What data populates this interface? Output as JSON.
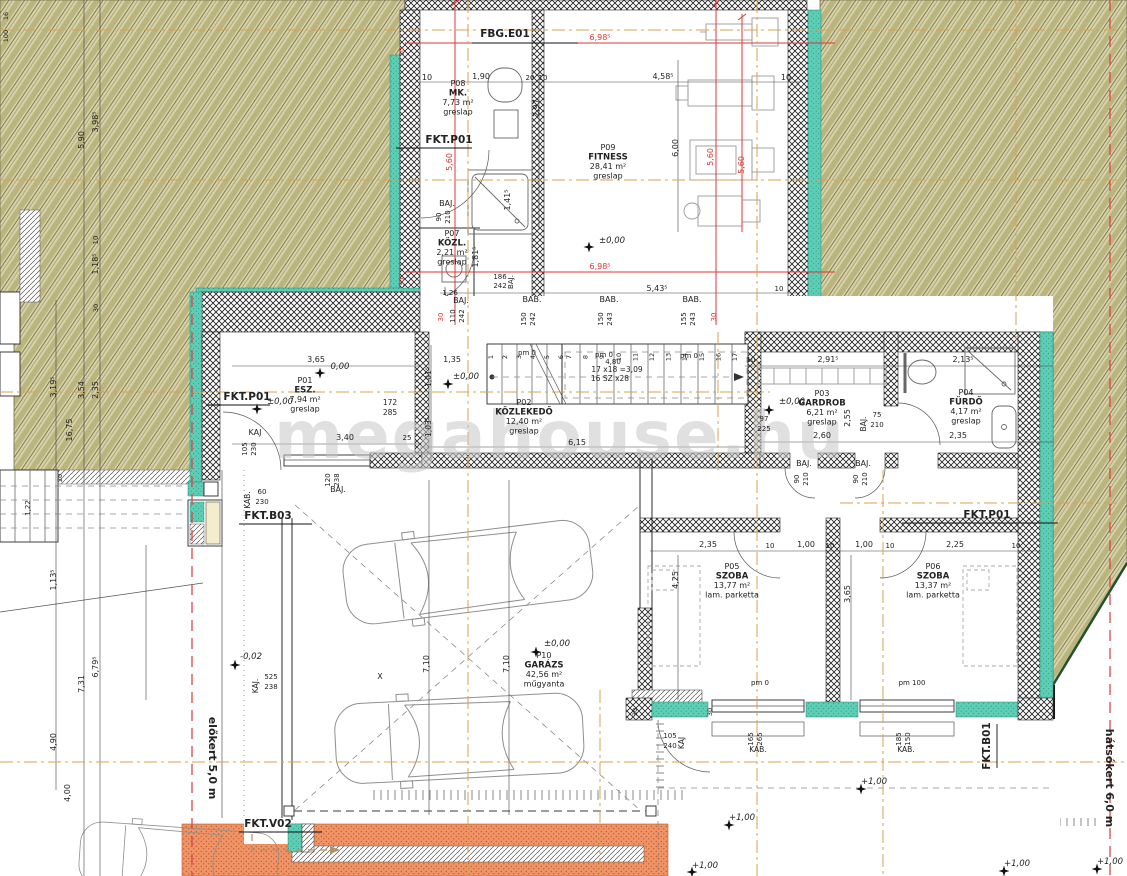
{
  "watermark": "megahouse.hu",
  "site": {
    "front": "előkert 5,0 m",
    "rear": "hátsókert 6,0 m"
  },
  "colors": {
    "terrain": "#d7d2a8",
    "terrain_stripe": "#bab47f",
    "teal": "#5ecdb5",
    "orange": "#f09467",
    "red_dim": "#e03434",
    "axis_orange": "#d7a254",
    "watermark_gray": "#c7c7c7"
  },
  "rooms": [
    {
      "id": "P01",
      "name": "ESZ.",
      "area": "7,94 m²",
      "floor": "greslap",
      "x": 305,
      "y": 383
    },
    {
      "id": "P02",
      "name": "KÖZLEKEDŐ",
      "area": "12,40 m²",
      "floor": "greslap",
      "x": 524,
      "y": 405
    },
    {
      "id": "P03",
      "name": "GARDROB",
      "area": "6,21 m²",
      "floor": "greslap",
      "x": 822,
      "y": 396
    },
    {
      "id": "P04",
      "name": "FÜRDŐ",
      "area": "4,17 m²",
      "floor": "greslap",
      "x": 966,
      "y": 395
    },
    {
      "id": "P05",
      "name": "SZOBA",
      "area": "13,77 m²",
      "floor": "lam. parketta",
      "x": 732,
      "y": 569
    },
    {
      "id": "P06",
      "name": "SZOBA",
      "area": "13,37 m²",
      "floor": "lam. parketta",
      "x": 933,
      "y": 569
    },
    {
      "id": "P07",
      "name": "KÖZL.",
      "area": "2,21 m²",
      "floor": "greslap",
      "x": 452,
      "y": 236
    },
    {
      "id": "P08",
      "name": "MK.",
      "area": "7,73 m²",
      "floor": "greslap",
      "x": 458,
      "y": 86
    },
    {
      "id": "P09",
      "name": "FITNESS",
      "area": "28,41 m²",
      "floor": "greslap",
      "x": 608,
      "y": 150
    },
    {
      "id": "P10",
      "name": "GARÁZS",
      "area": "42,56 m²",
      "floor": "műgyanta",
      "x": 544,
      "y": 658
    }
  ],
  "refs": [
    {
      "t": "FBG.E01",
      "x": 505,
      "y": 37,
      "lx1": 472,
      "ly1": 43,
      "lx2": 578,
      "ly2": 43
    },
    {
      "t": "FKT.P01",
      "x": 449,
      "y": 143,
      "lx1": 396,
      "ly1": 148,
      "lx2": 472,
      "ly2": 148
    },
    {
      "t": "FKT.P01",
      "x": 247,
      "y": 400,
      "lx1": 206,
      "ly1": 405,
      "lx2": 270,
      "ly2": 405
    },
    {
      "t": "FKT.B03",
      "x": 268,
      "y": 519,
      "lx1": 239,
      "ly1": 524,
      "lx2": 312,
      "ly2": 524
    },
    {
      "t": "FKT.V02",
      "x": 268,
      "y": 827,
      "lx1": 239,
      "ly1": 832,
      "lx2": 322,
      "ly2": 832
    },
    {
      "t": "FKT.P01",
      "x": 987,
      "y": 518,
      "lx1": 902,
      "ly1": 523,
      "lx2": 1058,
      "ly2": 523
    },
    {
      "t": "FKT.B01",
      "x": 990,
      "y": 746,
      "r": -90,
      "lx1": 997,
      "ly1": 724,
      "lx2": 997,
      "ly2": 768
    }
  ],
  "levels": [
    {
      "t": "±0,00",
      "x": 612,
      "y": 243,
      "sx": 589,
      "sy": 247
    },
    {
      "t": "±0,00",
      "x": 466,
      "y": 379,
      "sx": 448,
      "sy": 384
    },
    {
      "t": "0,00",
      "x": 340,
      "y": 369,
      "sx": 320,
      "sy": 373
    },
    {
      "t": "±0,00",
      "x": 280,
      "y": 404,
      "sx": 257,
      "sy": 409
    },
    {
      "t": "±0,00",
      "x": 792,
      "y": 404,
      "sx": 769,
      "sy": 410
    },
    {
      "t": "±0,00",
      "x": 557,
      "y": 646,
      "sx": 536,
      "sy": 652
    },
    {
      "t": "+1,00",
      "x": 874,
      "y": 784,
      "sx": 861,
      "sy": 789
    },
    {
      "t": "+1,00",
      "x": 742,
      "y": 820,
      "sx": 729,
      "sy": 825
    },
    {
      "t": "+1,00",
      "x": 705,
      "y": 868,
      "sx": 692,
      "sy": 872
    },
    {
      "t": "+1,00",
      "x": 1017,
      "y": 866,
      "sx": 1004,
      "sy": 871
    },
    {
      "t": "+1,00",
      "x": 1110,
      "y": 864,
      "sx": 1097,
      "sy": 869
    },
    {
      "t": "-0,02",
      "x": 251,
      "y": 659,
      "sx": 235,
      "sy": 665
    }
  ],
  "stairs": {
    "a": {
      "from": 1,
      "to": 6,
      "x0": 493,
      "dx": 14
    },
    "b": {
      "from": 7,
      "to": 17,
      "x0": 571,
      "dx": 16.6
    },
    "y": 357
  },
  "labels": [
    {
      "t": "10",
      "x": 427,
      "y": 80
    },
    {
      "t": "1,90",
      "x": 481,
      "y": 79
    },
    {
      "t": "20",
      "x": 530,
      "y": 80,
      "s": 7
    },
    {
      "t": "10",
      "x": 543,
      "y": 80,
      "s": 7
    },
    {
      "t": "4,58⁵",
      "x": 663,
      "y": 79
    },
    {
      "t": "10",
      "x": 786,
      "y": 80
    },
    {
      "t": "2,97",
      "x": 539,
      "y": 108,
      "r": -90
    },
    {
      "t": "6,00",
      "x": 678,
      "y": 148,
      "r": -90
    },
    {
      "t": "1,41⁵",
      "x": 510,
      "y": 200,
      "r": -90
    },
    {
      "t": "1,81⁵",
      "x": 478,
      "y": 257,
      "r": -90
    },
    {
      "t": "186",
      "x": 500,
      "y": 279,
      "s": 7
    },
    {
      "t": "242",
      "x": 500,
      "y": 288,
      "s": 7
    },
    {
      "t": "BAJ.",
      "x": 513,
      "y": 282,
      "r": -90,
      "s": 7
    },
    {
      "t": "BAJ.",
      "x": 447,
      "y": 206
    },
    {
      "t": "90",
      "x": 441,
      "y": 217,
      "r": -90,
      "s": 7
    },
    {
      "t": "210",
      "x": 450,
      "y": 217,
      "r": -90,
      "s": 7
    },
    {
      "t": "1,26",
      "x": 450,
      "y": 295,
      "s": 7
    },
    {
      "t": "BAJ.",
      "x": 461,
      "y": 303
    },
    {
      "t": "110",
      "x": 455,
      "y": 316,
      "r": -90,
      "s": 7
    },
    {
      "t": "242",
      "x": 464,
      "y": 316,
      "r": -90,
      "s": 7
    },
    {
      "t": "BAB.",
      "x": 532,
      "y": 302
    },
    {
      "t": "150",
      "x": 526,
      "y": 319,
      "r": -90,
      "s": 7
    },
    {
      "t": "242",
      "x": 535,
      "y": 319,
      "r": -90,
      "s": 7
    },
    {
      "t": "BAB.",
      "x": 609,
      "y": 302
    },
    {
      "t": "150",
      "x": 603,
      "y": 319,
      "r": -90,
      "s": 7
    },
    {
      "t": "243",
      "x": 612,
      "y": 319,
      "r": -90,
      "s": 7
    },
    {
      "t": "BAB.",
      "x": 692,
      "y": 302
    },
    {
      "t": "155",
      "x": 686,
      "y": 319,
      "r": -90,
      "s": 7
    },
    {
      "t": "243",
      "x": 695,
      "y": 319,
      "r": -90,
      "s": 7
    },
    {
      "t": "5,43⁵",
      "x": 657,
      "y": 291
    },
    {
      "t": "10",
      "x": 779,
      "y": 291,
      "s": 7
    },
    {
      "t": "6,98⁵",
      "x": 600,
      "y": 40,
      "c": "#e03434"
    },
    {
      "t": "6,98⁵",
      "x": 600,
      "y": 269,
      "c": "#e03434"
    },
    {
      "t": "5,60",
      "x": 452,
      "y": 162,
      "r": -90,
      "c": "#e03434"
    },
    {
      "t": "5,60",
      "x": 713,
      "y": 157,
      "r": -90,
      "c": "#e03434"
    },
    {
      "t": "5,60",
      "x": 744,
      "y": 165,
      "r": -90,
      "c": "#e03434"
    },
    {
      "t": "30",
      "x": 404,
      "y": 52,
      "r": -90,
      "c": "#e03434",
      "s": 7
    },
    {
      "t": "30",
      "x": 404,
      "y": 282,
      "r": -90,
      "c": "#e03434",
      "s": 7
    },
    {
      "t": "30",
      "x": 443,
      "y": 317,
      "r": -90,
      "c": "#e03434",
      "s": 7
    },
    {
      "t": "30",
      "x": 716,
      "y": 317,
      "r": -90,
      "c": "#e03434",
      "s": 7
    },
    {
      "t": "3,65",
      "x": 316,
      "y": 362
    },
    {
      "t": "1,35",
      "x": 452,
      "y": 362
    },
    {
      "t": "172",
      "x": 390,
      "y": 405,
      "s": 7.5
    },
    {
      "t": "285",
      "x": 390,
      "y": 415,
      "s": 7.5
    },
    {
      "t": "2,91⁵",
      "x": 828,
      "y": 362
    },
    {
      "t": "2,13⁵",
      "x": 963,
      "y": 362
    },
    {
      "t": "10",
      "x": 751,
      "y": 362,
      "s": 7
    },
    {
      "t": "3,40",
      "x": 345,
      "y": 440
    },
    {
      "t": "25",
      "x": 407,
      "y": 440,
      "s": 7
    },
    {
      "t": "6,15",
      "x": 577,
      "y": 445
    },
    {
      "t": "2,60",
      "x": 822,
      "y": 438
    },
    {
      "t": "2,35",
      "x": 958,
      "y": 438
    },
    {
      "t": "97",
      "x": 764,
      "y": 421,
      "s": 7
    },
    {
      "t": "225",
      "x": 764,
      "y": 431,
      "s": 7
    },
    {
      "t": "BAJ.",
      "x": 866,
      "y": 424,
      "r": -90,
      "s": 7.5
    },
    {
      "t": "75",
      "x": 877,
      "y": 417,
      "s": 7
    },
    {
      "t": "210",
      "x": 877,
      "y": 427,
      "s": 7
    },
    {
      "t": "2,55",
      "x": 850,
      "y": 418,
      "r": -90
    },
    {
      "t": "1,01⁵",
      "x": 431,
      "y": 377,
      "r": -90,
      "s": 7.5
    },
    {
      "t": "1,03⁵",
      "x": 431,
      "y": 427,
      "r": -90,
      "s": 7.5
    },
    {
      "t": "KAJ",
      "x": 255,
      "y": 435
    },
    {
      "t": "105",
      "x": 247,
      "y": 449,
      "r": -90,
      "s": 7
    },
    {
      "t": "230",
      "x": 256,
      "y": 449,
      "r": -90,
      "s": 7
    },
    {
      "t": "BAJ.",
      "x": 338,
      "y": 492
    },
    {
      "t": "120",
      "x": 330,
      "y": 480,
      "r": -90,
      "s": 7
    },
    {
      "t": "238",
      "x": 339,
      "y": 480,
      "r": -90,
      "s": 7
    },
    {
      "t": "KAB.",
      "x": 250,
      "y": 500,
      "r": -90,
      "s": 7.5
    },
    {
      "t": "60",
      "x": 262,
      "y": 494,
      "s": 7
    },
    {
      "t": "230",
      "x": 262,
      "y": 504,
      "s": 7
    },
    {
      "t": "BAJ.",
      "x": 804,
      "y": 466
    },
    {
      "t": "90",
      "x": 799,
      "y": 479,
      "r": -90,
      "s": 7
    },
    {
      "t": "210",
      "x": 808,
      "y": 479,
      "r": -90,
      "s": 7
    },
    {
      "t": "BAJ.",
      "x": 863,
      "y": 466
    },
    {
      "t": "90",
      "x": 858,
      "y": 479,
      "r": -90,
      "s": 7
    },
    {
      "t": "210",
      "x": 867,
      "y": 479,
      "r": -90,
      "s": 7
    },
    {
      "t": "pm 0",
      "x": 527,
      "y": 355,
      "s": 7
    },
    {
      "t": "pm 0",
      "x": 604,
      "y": 357,
      "s": 7
    },
    {
      "t": "pm 0",
      "x": 689,
      "y": 358,
      "s": 7
    },
    {
      "t": "4,80",
      "x": 613,
      "y": 364,
      "s": 7
    },
    {
      "t": "17 x18 =3,09",
      "x": 617,
      "y": 372,
      "s": 7.5
    },
    {
      "t": "16 SZ x28",
      "x": 610,
      "y": 381,
      "s": 7.5
    },
    {
      "t": "2,35",
      "x": 708,
      "y": 547
    },
    {
      "t": "10",
      "x": 770,
      "y": 548,
      "s": 7
    },
    {
      "t": "1,00",
      "x": 806,
      "y": 547
    },
    {
      "t": "10",
      "x": 830,
      "y": 548,
      "s": 7
    },
    {
      "t": "1,00",
      "x": 864,
      "y": 547
    },
    {
      "t": "10",
      "x": 890,
      "y": 548,
      "s": 7
    },
    {
      "t": "2,25",
      "x": 955,
      "y": 547
    },
    {
      "t": "10",
      "x": 1016,
      "y": 548,
      "s": 7
    },
    {
      "t": "4,25",
      "x": 678,
      "y": 580,
      "r": -90
    },
    {
      "t": "3,65",
      "x": 850,
      "y": 594,
      "r": -90
    },
    {
      "t": "pm 0",
      "x": 760,
      "y": 685,
      "s": 7
    },
    {
      "t": "pm 100",
      "x": 912,
      "y": 685,
      "s": 7
    },
    {
      "t": "105",
      "x": 670,
      "y": 738,
      "s": 7
    },
    {
      "t": "240",
      "x": 670,
      "y": 748,
      "s": 7
    },
    {
      "t": "KAJ",
      "x": 684,
      "y": 743,
      "r": -90,
      "s": 7.5
    },
    {
      "t": "165",
      "x": 753,
      "y": 739,
      "r": -90,
      "s": 7
    },
    {
      "t": "265",
      "x": 762,
      "y": 739,
      "r": -90,
      "s": 7
    },
    {
      "t": "KAB.",
      "x": 758,
      "y": 752,
      "s": 7.5
    },
    {
      "t": "185",
      "x": 901,
      "y": 739,
      "r": -90,
      "s": 7
    },
    {
      "t": "150",
      "x": 910,
      "y": 739,
      "r": -90,
      "s": 7
    },
    {
      "t": "KAB.",
      "x": 906,
      "y": 752,
      "s": 7.5
    },
    {
      "t": "30",
      "x": 637,
      "y": 712,
      "r": -90,
      "s": 6.5
    },
    {
      "t": "30",
      "x": 712,
      "y": 712,
      "r": -90,
      "s": 6.5
    },
    {
      "t": "7,10",
      "x": 429,
      "y": 664,
      "r": -90
    },
    {
      "t": "7,10",
      "x": 509,
      "y": 664,
      "r": -90
    },
    {
      "t": "X",
      "x": 380,
      "y": 679,
      "s": 8
    },
    {
      "t": "KAJ.",
      "x": 258,
      "y": 686,
      "r": -90,
      "s": 7.5
    },
    {
      "t": "525",
      "x": 271,
      "y": 679,
      "s": 7
    },
    {
      "t": "238",
      "x": 271,
      "y": 689,
      "s": 7
    },
    {
      "t": "5,90",
      "x": 84,
      "y": 140,
      "r": -90
    },
    {
      "t": "3,98⁵",
      "x": 98,
      "y": 122,
      "r": -90
    },
    {
      "t": "10",
      "x": 98,
      "y": 240,
      "r": -90,
      "s": 7
    },
    {
      "t": "1,18⁵",
      "x": 98,
      "y": 264,
      "r": -90
    },
    {
      "t": "16",
      "x": 8,
      "y": 16,
      "r": -90,
      "s": 6.5
    },
    {
      "t": "100",
      "x": 8,
      "y": 36,
      "r": -90,
      "s": 6.5
    },
    {
      "t": "3,19⁵",
      "x": 56,
      "y": 387,
      "r": -90
    },
    {
      "t": "3,54",
      "x": 84,
      "y": 390,
      "r": -90
    },
    {
      "t": "2,35",
      "x": 98,
      "y": 390,
      "r": -90
    },
    {
      "t": "16,75",
      "x": 72,
      "y": 430,
      "r": -90
    },
    {
      "t": "30",
      "x": 98,
      "y": 308,
      "r": -90,
      "s": 6.5
    },
    {
      "t": "20",
      "x": 62,
      "y": 478,
      "r": -90,
      "s": 6.5
    },
    {
      "t": "1,22",
      "x": 30,
      "y": 508,
      "r": -90,
      "s": 7
    },
    {
      "t": "1,13⁵",
      "x": 56,
      "y": 580,
      "r": -90
    },
    {
      "t": "7,31",
      "x": 84,
      "y": 684,
      "r": -90
    },
    {
      "t": "6,79⁵",
      "x": 98,
      "y": 667,
      "r": -90
    },
    {
      "t": "4,90",
      "x": 56,
      "y": 742,
      "r": -90
    },
    {
      "t": "4,00",
      "x": 70,
      "y": 793,
      "r": -90
    }
  ]
}
